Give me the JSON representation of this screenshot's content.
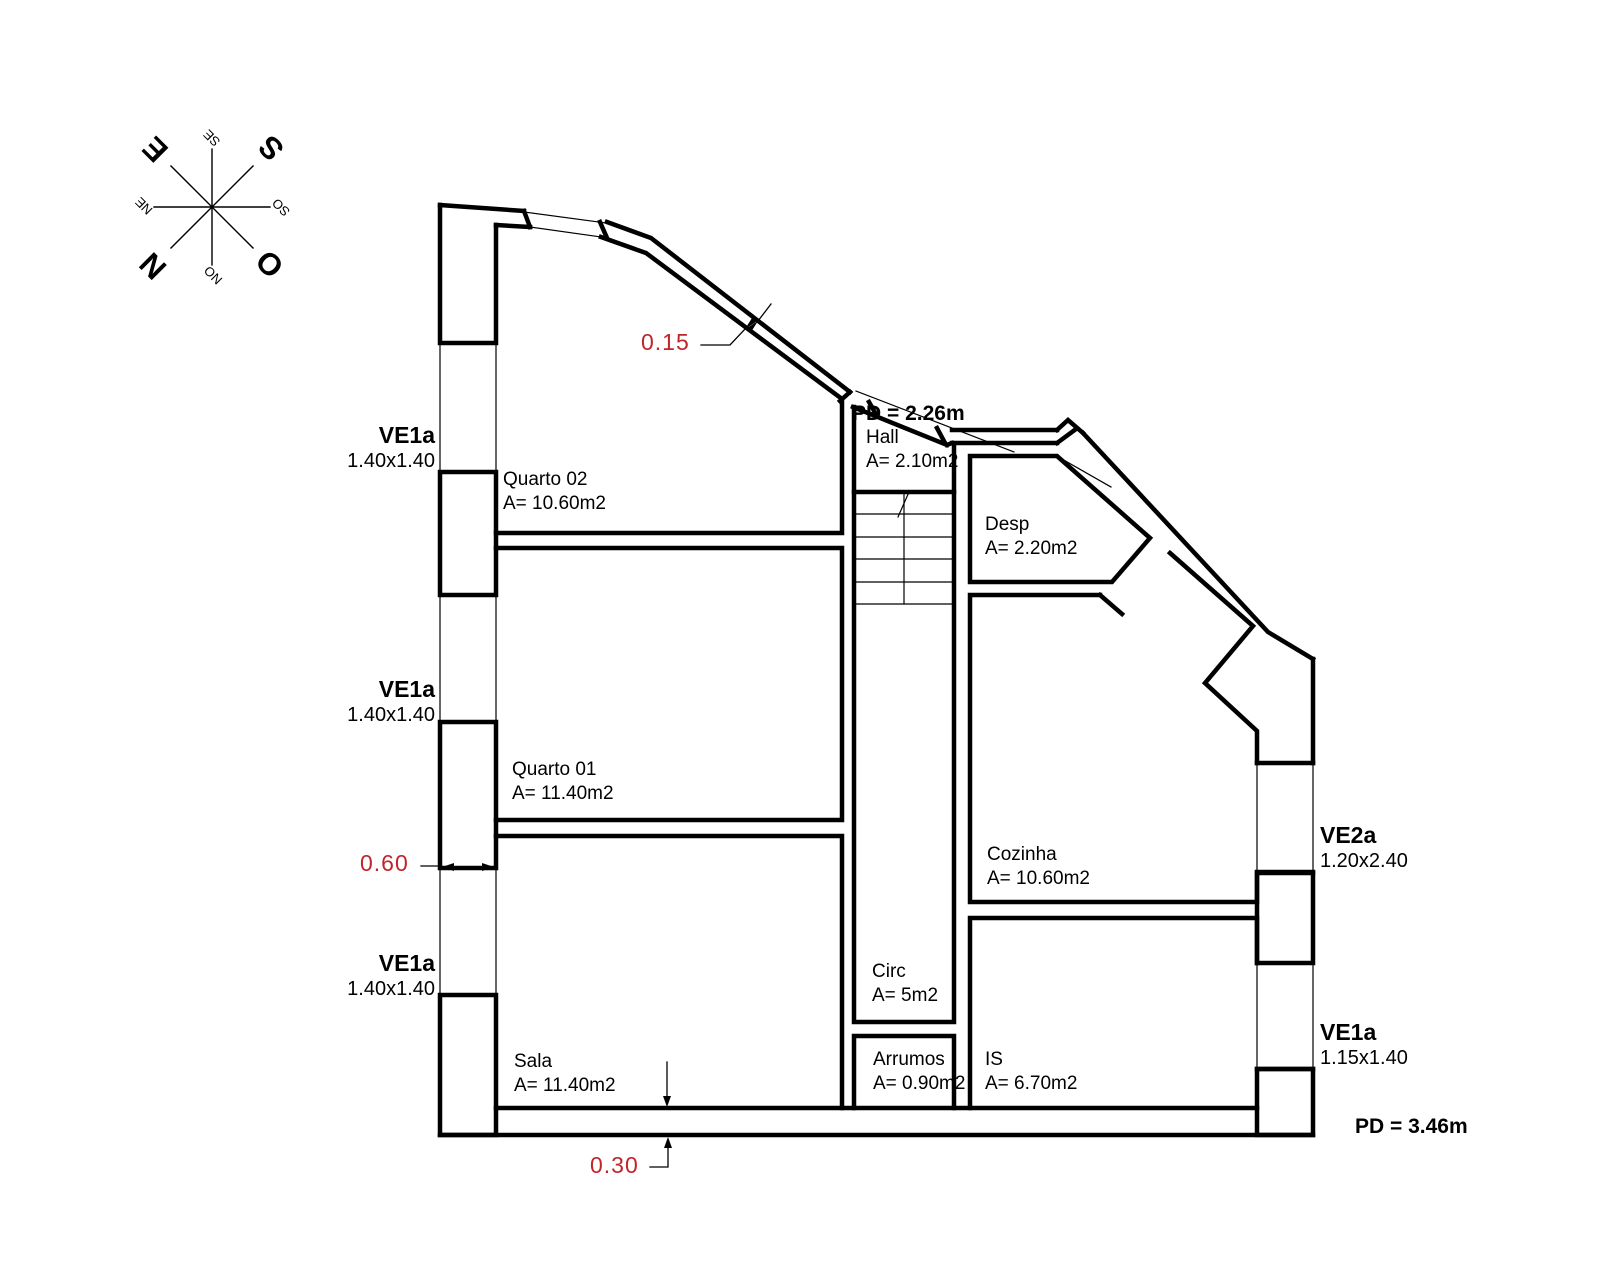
{
  "drawing": {
    "type": "floor-plan",
    "background": "#ffffff",
    "line_color": "#000000",
    "dimension_text_color": "#c1252b"
  },
  "compass": {
    "n": "N",
    "s": "S",
    "e": "E",
    "o": "O",
    "ne": "NE",
    "se": "SE",
    "so": "SO",
    "no": "NO"
  },
  "rooms": {
    "quarto02": {
      "name": "Quarto 02",
      "area": "A= 10.60m2"
    },
    "quarto01": {
      "name": "Quarto 01",
      "area": "A= 11.40m2"
    },
    "sala": {
      "name": "Sala",
      "area": "A= 11.40m2"
    },
    "hall": {
      "name": "Hall",
      "area": "A= 2.10m2"
    },
    "desp": {
      "name": "Desp",
      "area": "A= 2.20m2"
    },
    "cozinha": {
      "name": "Cozinha",
      "area": "A= 10.60m2"
    },
    "circ": {
      "name": "Circ",
      "area": "A= 5m2"
    },
    "arrumos": {
      "name": "Arrumos",
      "area": "A= 0.90m2"
    },
    "is": {
      "name": "IS",
      "area": "A= 6.70m2"
    }
  },
  "windows": {
    "west1": {
      "code": "VE1a",
      "size": "1.40x1.40"
    },
    "west2": {
      "code": "VE1a",
      "size": "1.40x1.40"
    },
    "west3": {
      "code": "VE1a",
      "size": "1.40x1.40"
    },
    "east1": {
      "code": "VE2a",
      "size": "1.20x2.40"
    },
    "east2": {
      "code": "VE1a",
      "size": "1.15x1.40"
    }
  },
  "dimensions": {
    "diagonal_wall_thickness": "0.15",
    "west_wall_thickness": "0.60",
    "south_wall_thickness": "0.30"
  },
  "ceiling_heights": {
    "hall": "PD = 2.26m",
    "main": "PD = 3.46m"
  }
}
